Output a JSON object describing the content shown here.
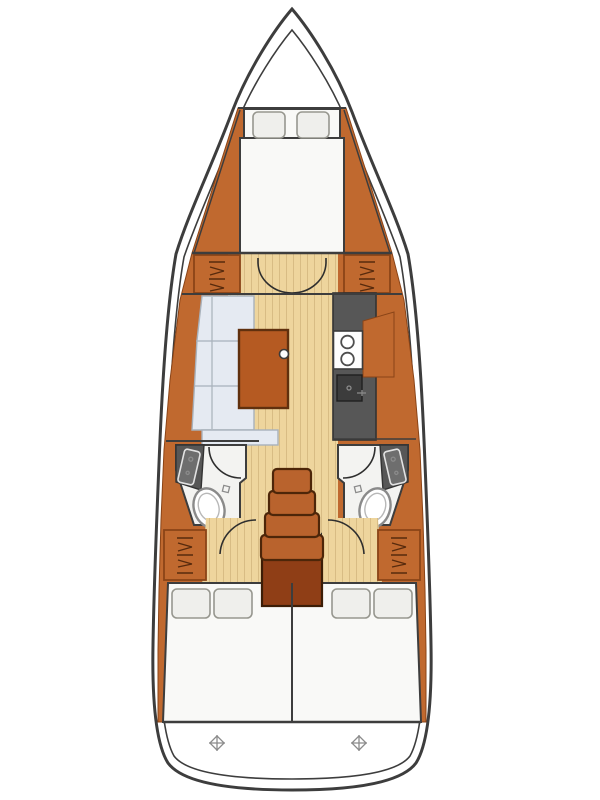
{
  "meta": {
    "title": "Sailing yacht interior layout plan — overhead view",
    "diagram_type": "yacht-floor-plan"
  },
  "colors": {
    "outline": "#3d3d3d",
    "wood": "#c0692f",
    "wood-border": "#8a4417",
    "wood-dark": "#8f3e16",
    "stairs": "#b9632d",
    "table": "#b55a22",
    "table-border": "#60300e",
    "floor": "#eed59d",
    "floor-line": "#d8bc84",
    "settee": "#e5eaf2",
    "settee-seam": "#a8b1bb",
    "bed": "#f9f9f7",
    "pillow": "#efefec",
    "pillow-border": "#97978f",
    "counter": "#575757",
    "counter-dark": "#333333",
    "fixture": "#8a8a8a",
    "head-floor": "#f3f3f1"
  },
  "vessel": {
    "rooms": [
      {
        "id": "forward-cabin",
        "name": "Forward V-berth cabin",
        "features": [
          "double berth",
          "two pillows"
        ]
      },
      {
        "id": "saloon",
        "name": "Main saloon",
        "features": [
          "L-shaped settee",
          "folding table",
          "double entry doors"
        ]
      },
      {
        "id": "galley",
        "name": "Galley",
        "features": [
          "two-burner stove",
          "sink",
          "worktop"
        ]
      },
      {
        "id": "head-port",
        "name": "Port head",
        "features": [
          "toilet",
          "washbasin",
          "shower"
        ]
      },
      {
        "id": "head-starboard",
        "name": "Starboard head",
        "features": [
          "toilet",
          "washbasin",
          "shower"
        ]
      },
      {
        "id": "companionway",
        "name": "Companionway steps",
        "features": [
          "four steps",
          "engine box"
        ]
      },
      {
        "id": "aft-cabin-port",
        "name": "Port aft double cabin",
        "features": [
          "double berth",
          "two pillows",
          "hanging locker"
        ]
      },
      {
        "id": "aft-cabin-starboard",
        "name": "Starboard aft double cabin",
        "features": [
          "double berth",
          "two pillows",
          "hanging locker"
        ]
      },
      {
        "id": "transom",
        "name": "Transom / aft deck",
        "features": [
          "two deck fittings"
        ]
      }
    ],
    "icons": [
      "hull-outline",
      "deck-edge-line",
      "door-swing-icon",
      "hanger-locker-icon",
      "stove-burner-icon",
      "sink-icon",
      "faucet-icon",
      "toilet-icon",
      "washbasin-icon",
      "shower-curtain-arc-icon",
      "table-knob-icon",
      "deck-fitting-icon"
    ]
  }
}
